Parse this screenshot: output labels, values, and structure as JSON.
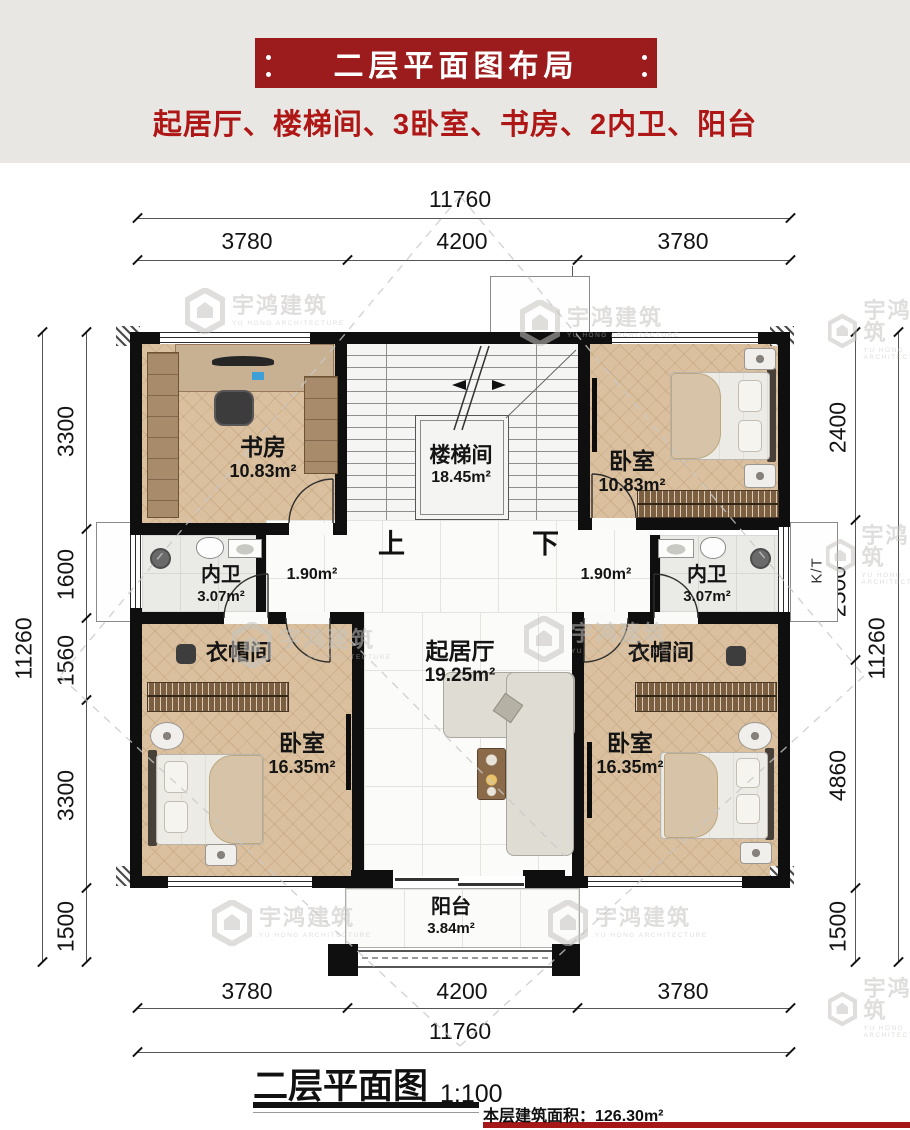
{
  "header": {
    "title": "二层平面图布局",
    "subtitle": "起居厅、楼梯间、3卧室、书房、2内卫、阳台"
  },
  "watermark": {
    "name": "宇鸿建筑",
    "sub": "YU HONG ARCHITECTURE"
  },
  "dimensions": {
    "top": {
      "total": "11760",
      "segments": [
        "3780",
        "4200",
        "3780"
      ]
    },
    "bottom": {
      "total": "11760",
      "segments": [
        "3780",
        "4200",
        "3780"
      ]
    },
    "left": {
      "total": "11260",
      "segments": [
        "3300",
        "1600",
        "1560",
        "3300",
        "1500"
      ]
    },
    "right": {
      "total": "11260",
      "segments": [
        "2400",
        "2500",
        "4860",
        "1500"
      ]
    }
  },
  "rooms": {
    "study": {
      "name": "书房",
      "area": "10.83m²"
    },
    "stairs": {
      "name": "楼梯间",
      "area": "18.45m²"
    },
    "bedroom_tr": {
      "name": "卧室",
      "area": "10.83m²"
    },
    "bath_left": {
      "name": "内卫",
      "area": "3.07m²"
    },
    "bath_right": {
      "name": "内卫",
      "area": "3.07m²"
    },
    "hall_left": {
      "area": "1.90m²"
    },
    "hall_right": {
      "area": "1.90m²"
    },
    "living": {
      "name": "起居厅",
      "area": "19.25m²"
    },
    "closet_left": {
      "name": "衣帽间"
    },
    "closet_right": {
      "name": "衣帽间"
    },
    "bedroom_bl": {
      "name": "卧室",
      "area": "16.35m²"
    },
    "bedroom_br": {
      "name": "卧室",
      "area": "16.35m²"
    },
    "balcony": {
      "name": "阳台",
      "area": "3.84m²"
    }
  },
  "stair_labels": {
    "up": "上",
    "down": "下"
  },
  "kt_label": "K/T",
  "footer": {
    "caption": "二层平面图",
    "scale": "1:100",
    "area_note": "本层建筑面积：126.30m²"
  },
  "colors": {
    "banner_red": "#9c1b1c",
    "subtitle_red": "#ae1715",
    "footer_bar_red": "#a61717",
    "wall_black": "#0f0f0f",
    "wood_floor": "#dac09e"
  }
}
